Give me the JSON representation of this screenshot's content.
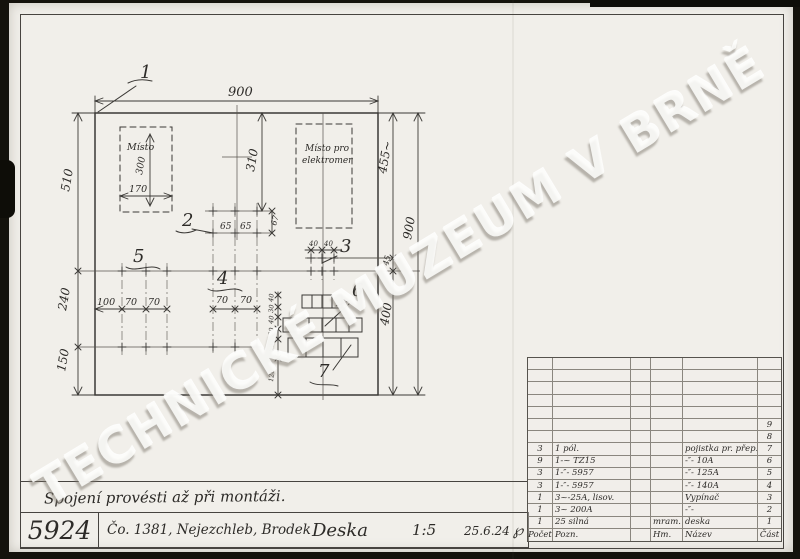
{
  "watermark": "TECHNICKÉ MUZEUM V BRNĚ",
  "drawing": {
    "labels": {
      "l1": "1",
      "l2": "2",
      "l3": "3",
      "l4": "4",
      "l5": "5",
      "l6": "6",
      "l7": "7"
    },
    "areas": {
      "misto": "Místo",
      "misto_pro": "Místo pro",
      "elektromer": "elektromer"
    },
    "dims": {
      "top_width": "900",
      "left_top": "510",
      "left_mid": "240",
      "left_bottom": "150",
      "mid_height": "310",
      "right_upper": "455~",
      "right_45": "45",
      "right_lower": "400",
      "right_total": "900",
      "misto_h": "300",
      "misto_w": "170",
      "g2_a": "65",
      "g2_b": "65",
      "g2_v": "67",
      "g3_a": "40",
      "g3_b": "40",
      "g4_a": "70",
      "g4_b": "70",
      "g5_a": "100",
      "g5_b": "70",
      "g5_c": "70",
      "vchain": [
        "40",
        "30",
        "40",
        "30",
        "60",
        "120"
      ]
    }
  },
  "note": "Spojení provésti až při montáži.",
  "title_block": {
    "number": "5924",
    "order": "Čo. 1381, Nejezchleb, Brodek",
    "name": "Deska",
    "scale": "1:5",
    "date": "25.6.24",
    "signature": "℘"
  },
  "parts_table": {
    "headers": {
      "pocet": "Počet",
      "pozn": "Pozn.",
      "hm": "Hm.",
      "nazev": "Název",
      "cast": "Část"
    },
    "rows": [
      {
        "pocet": "",
        "pozn": "",
        "hm": "",
        "nazev": "",
        "cast": "9"
      },
      {
        "pocet": "",
        "pozn": "",
        "hm": "",
        "nazev": "",
        "cast": "8"
      },
      {
        "pocet": "3",
        "pozn": "1 pól.",
        "hm": "",
        "nazev": "pojistka pr. přep.",
        "cast": "7"
      },
      {
        "pocet": "9",
        "pozn": "1-~ TZ15",
        "hm": "",
        "nazev": "-″- 10A",
        "cast": "6"
      },
      {
        "pocet": "3",
        "pozn": "1-″- 5957",
        "hm": "",
        "nazev": "-″- 125A",
        "cast": "5"
      },
      {
        "pocet": "3",
        "pozn": "1-″- 5957",
        "hm": "",
        "nazev": "-″- 140A",
        "cast": "4"
      },
      {
        "pocet": "1",
        "pozn": "3~-25A, lisov.",
        "hm": "",
        "nazev": "Vypínač",
        "cast": "3"
      },
      {
        "pocet": "1",
        "pozn": "3~ 200A",
        "hm": "",
        "nazev": "-″-",
        "cast": "2"
      },
      {
        "pocet": "1",
        "pozn": "25 silná",
        "hm": "mram.",
        "nazev": "deska",
        "cast": "1"
      }
    ]
  }
}
